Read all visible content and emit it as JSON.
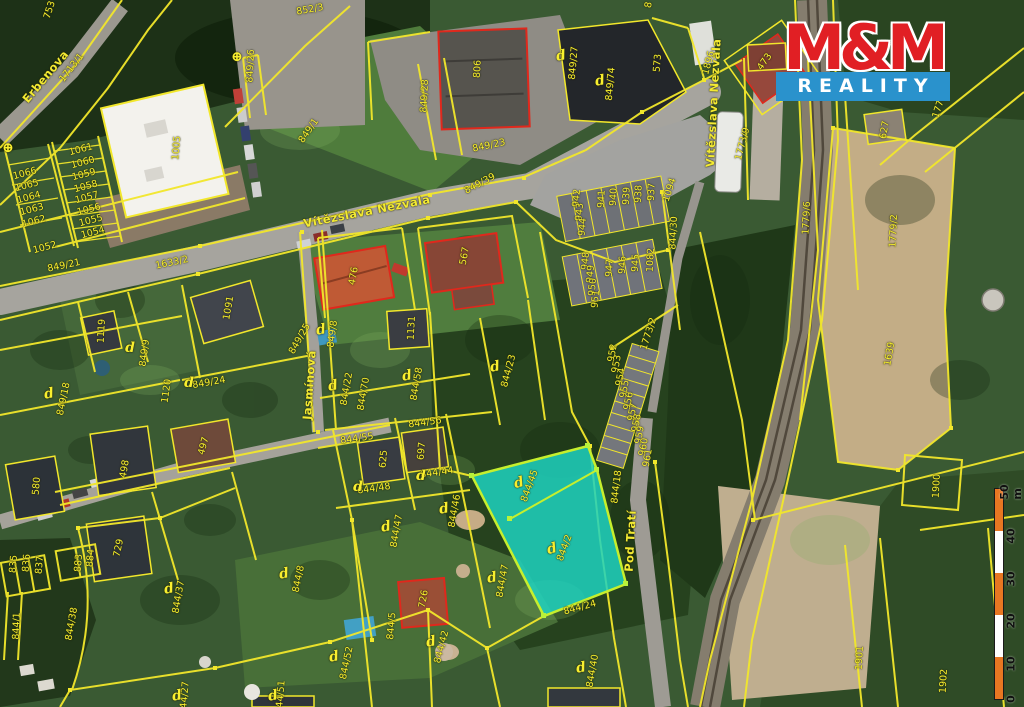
{
  "logo": {
    "top": "M&M",
    "bottom": "REALITY"
  },
  "colors": {
    "parcel_line": "#f2e72b",
    "parcel_label": "#f8ef2f",
    "building_outline_red": "#e0281c",
    "highlight_fill": "#1ed2c0",
    "highlight_stroke": "#c6ef2d",
    "logo_red": "#e11f24",
    "logo_blue": "#2a92cc",
    "scale_orange": "#e87722"
  },
  "map": {
    "highlighted_parcels": [
      "844/45",
      "844/2"
    ],
    "street_names": [
      "Erbenova",
      "Vítězslava Nezvala",
      "Jasmínová",
      "Pod Tratí"
    ],
    "labels": [
      {
        "t": "Erbenova",
        "x": 46,
        "y": 77,
        "r": -50,
        "k": "street"
      },
      {
        "t": "Vítězslava Nezvala",
        "x": 367,
        "y": 212,
        "r": -11,
        "k": "street"
      },
      {
        "t": "Vítězslava Nezvala",
        "x": 714,
        "y": 103,
        "r": -87,
        "k": "street"
      },
      {
        "t": "Jasmínová",
        "x": 310,
        "y": 385,
        "r": -86,
        "k": "street"
      },
      {
        "t": "Pod Tratí",
        "x": 631,
        "y": 541,
        "r": -87,
        "k": "street"
      },
      {
        "t": "852/3",
        "x": 310,
        "y": 10,
        "r": -10
      },
      {
        "t": "8",
        "x": 649,
        "y": 5,
        "r": -80
      },
      {
        "t": "753",
        "x": 50,
        "y": 10,
        "r": -72
      },
      {
        "t": "1713/1",
        "x": 72,
        "y": 68,
        "r": -52
      },
      {
        "t": "849/26",
        "x": 251,
        "y": 66,
        "r": -87
      },
      {
        "t": "849/1",
        "x": 309,
        "y": 131,
        "r": -55
      },
      {
        "t": "849/28",
        "x": 425,
        "y": 96,
        "r": -87
      },
      {
        "t": "806",
        "x": 478,
        "y": 69,
        "r": -87
      },
      {
        "t": "849/23",
        "x": 489,
        "y": 146,
        "r": -12
      },
      {
        "t": "849/39",
        "x": 480,
        "y": 184,
        "r": -28
      },
      {
        "t": "849/27",
        "x": 574,
        "y": 63,
        "r": -85
      },
      {
        "t": "849/74",
        "x": 611,
        "y": 84,
        "r": -85
      },
      {
        "t": "573",
        "x": 658,
        "y": 63,
        "r": -85
      },
      {
        "t": "1896",
        "x": 709,
        "y": 63,
        "r": -75
      },
      {
        "t": "473",
        "x": 765,
        "y": 62,
        "r": -55
      },
      {
        "t": "1773/9",
        "x": 743,
        "y": 144,
        "r": -75
      },
      {
        "t": "1779/8",
        "x": 941,
        "y": 102,
        "r": -72
      },
      {
        "t": "627",
        "x": 885,
        "y": 130,
        "r": -80
      },
      {
        "t": "1779/6",
        "x": 807,
        "y": 218,
        "r": -87
      },
      {
        "t": "1779/2",
        "x": 894,
        "y": 231,
        "r": -87
      },
      {
        "t": "1639",
        "x": 890,
        "y": 354,
        "r": -80
      },
      {
        "t": "1900",
        "x": 937,
        "y": 486,
        "r": -87
      },
      {
        "t": "1901",
        "x": 860,
        "y": 658,
        "r": -87
      },
      {
        "t": "1902",
        "x": 944,
        "y": 681,
        "r": -87
      },
      {
        "t": "1094",
        "x": 670,
        "y": 190,
        "r": -72
      },
      {
        "t": "942",
        "x": 577,
        "y": 198,
        "r": -85
      },
      {
        "t": "943",
        "x": 580,
        "y": 212,
        "r": -85
      },
      {
        "t": "944",
        "x": 583,
        "y": 227,
        "r": -85
      },
      {
        "t": "941",
        "x": 602,
        "y": 199,
        "r": -87
      },
      {
        "t": "940",
        "x": 614,
        "y": 197,
        "r": -87
      },
      {
        "t": "939",
        "x": 627,
        "y": 196,
        "r": -87
      },
      {
        "t": "938",
        "x": 639,
        "y": 194,
        "r": -87
      },
      {
        "t": "937",
        "x": 652,
        "y": 192,
        "r": -87
      },
      {
        "t": "948",
        "x": 586,
        "y": 261,
        "r": -85
      },
      {
        "t": "949",
        "x": 591,
        "y": 274,
        "r": -85
      },
      {
        "t": "950",
        "x": 593,
        "y": 287,
        "r": -85
      },
      {
        "t": "951",
        "x": 596,
        "y": 299,
        "r": -85
      },
      {
        "t": "947",
        "x": 610,
        "y": 268,
        "r": -87
      },
      {
        "t": "946",
        "x": 623,
        "y": 265,
        "r": -87
      },
      {
        "t": "945",
        "x": 636,
        "y": 263,
        "r": -87
      },
      {
        "t": "1082",
        "x": 651,
        "y": 260,
        "r": -87
      },
      {
        "t": "844/30",
        "x": 674,
        "y": 233,
        "r": -87
      },
      {
        "t": "952",
        "x": 613,
        "y": 353,
        "r": -80
      },
      {
        "t": "953",
        "x": 617,
        "y": 364,
        "r": -80
      },
      {
        "t": "954",
        "x": 621,
        "y": 377,
        "r": -80
      },
      {
        "t": "955",
        "x": 625,
        "y": 389,
        "r": -80
      },
      {
        "t": "956",
        "x": 629,
        "y": 401,
        "r": -80
      },
      {
        "t": "957",
        "x": 633,
        "y": 412,
        "r": -80
      },
      {
        "t": "958",
        "x": 637,
        "y": 423,
        "r": -80
      },
      {
        "t": "959",
        "x": 640,
        "y": 435,
        "r": -80
      },
      {
        "t": "960",
        "x": 644,
        "y": 447,
        "r": -80
      },
      {
        "t": "961",
        "x": 648,
        "y": 458,
        "r": -80
      },
      {
        "t": "1773/2",
        "x": 649,
        "y": 334,
        "r": -72
      },
      {
        "t": "844/18",
        "x": 617,
        "y": 487,
        "r": -83
      },
      {
        "t": "844/45",
        "x": 530,
        "y": 486,
        "r": -70
      },
      {
        "t": "844/2",
        "x": 565,
        "y": 548,
        "r": -70
      },
      {
        "t": "844/24",
        "x": 580,
        "y": 608,
        "r": -15
      },
      {
        "t": "844/46",
        "x": 455,
        "y": 511,
        "r": -80
      },
      {
        "t": "844/47",
        "x": 503,
        "y": 581,
        "r": -80
      },
      {
        "t": "844/47",
        "x": 397,
        "y": 531,
        "r": -80
      },
      {
        "t": "844/40",
        "x": 593,
        "y": 671,
        "r": -80
      },
      {
        "t": "844/42",
        "x": 442,
        "y": 647,
        "r": -75
      },
      {
        "t": "726",
        "x": 424,
        "y": 599,
        "r": -80
      },
      {
        "t": "844/5",
        "x": 392,
        "y": 626,
        "r": -85
      },
      {
        "t": "844/52",
        "x": 347,
        "y": 663,
        "r": -78
      },
      {
        "t": "844/51",
        "x": 281,
        "y": 697,
        "r": -85
      },
      {
        "t": "844/27",
        "x": 185,
        "y": 698,
        "r": -85
      },
      {
        "t": "844/8",
        "x": 299,
        "y": 579,
        "r": -78
      },
      {
        "t": "844/37",
        "x": 179,
        "y": 597,
        "r": -80
      },
      {
        "t": "844/38",
        "x": 72,
        "y": 624,
        "r": -80
      },
      {
        "t": "844/1",
        "x": 17,
        "y": 626,
        "r": -88
      },
      {
        "t": "883",
        "x": 79,
        "y": 563,
        "r": -85
      },
      {
        "t": "884",
        "x": 91,
        "y": 558,
        "r": -85
      },
      {
        "t": "835",
        "x": 14,
        "y": 564,
        "r": -85
      },
      {
        "t": "836",
        "x": 27,
        "y": 563,
        "r": -85
      },
      {
        "t": "837",
        "x": 40,
        "y": 565,
        "r": -85
      },
      {
        "t": "729",
        "x": 119,
        "y": 548,
        "r": -78
      },
      {
        "t": "580",
        "x": 37,
        "y": 486,
        "r": -85
      },
      {
        "t": "498",
        "x": 125,
        "y": 469,
        "r": -80
      },
      {
        "t": "497",
        "x": 204,
        "y": 446,
        "r": -75
      },
      {
        "t": "625",
        "x": 384,
        "y": 459,
        "r": -85
      },
      {
        "t": "697",
        "x": 422,
        "y": 451,
        "r": -85
      },
      {
        "t": "844/56",
        "x": 425,
        "y": 423,
        "r": -8
      },
      {
        "t": "844/55",
        "x": 357,
        "y": 439,
        "r": -8
      },
      {
        "t": "844/44",
        "x": 437,
        "y": 473,
        "r": -8
      },
      {
        "t": "844/48",
        "x": 374,
        "y": 489,
        "r": -8
      },
      {
        "t": "844/23",
        "x": 509,
        "y": 371,
        "r": -75
      },
      {
        "t": "844/58",
        "x": 417,
        "y": 384,
        "r": -80
      },
      {
        "t": "844/22",
        "x": 347,
        "y": 389,
        "r": -80
      },
      {
        "t": "844/70",
        "x": 364,
        "y": 394,
        "r": -80
      },
      {
        "t": "849/25",
        "x": 300,
        "y": 339,
        "r": -60
      },
      {
        "t": "849/8",
        "x": 333,
        "y": 334,
        "r": -82
      },
      {
        "t": "1131",
        "x": 412,
        "y": 328,
        "r": -87
      },
      {
        "t": "476",
        "x": 354,
        "y": 276,
        "r": -80
      },
      {
        "t": "567",
        "x": 465,
        "y": 256,
        "r": -80
      },
      {
        "t": "1119",
        "x": 102,
        "y": 331,
        "r": -87
      },
      {
        "t": "1091",
        "x": 229,
        "y": 308,
        "r": -80
      },
      {
        "t": "849/18",
        "x": 64,
        "y": 399,
        "r": -78
      },
      {
        "t": "1120",
        "x": 167,
        "y": 391,
        "r": -82
      },
      {
        "t": "849/24",
        "x": 209,
        "y": 383,
        "r": -10
      },
      {
        "t": "849/9",
        "x": 145,
        "y": 353,
        "r": -82
      },
      {
        "t": "849/21",
        "x": 64,
        "y": 266,
        "r": -12
      },
      {
        "t": "1633/2",
        "x": 172,
        "y": 263,
        "r": -12
      },
      {
        "t": "1005",
        "x": 177,
        "y": 148,
        "r": -85
      },
      {
        "t": "1061",
        "x": 81,
        "y": 150,
        "r": -15
      },
      {
        "t": "1060",
        "x": 83,
        "y": 163,
        "r": -15
      },
      {
        "t": "1059",
        "x": 84,
        "y": 175,
        "r": -15
      },
      {
        "t": "1058",
        "x": 86,
        "y": 187,
        "r": -15
      },
      {
        "t": "1057",
        "x": 87,
        "y": 198,
        "r": -15
      },
      {
        "t": "1056",
        "x": 89,
        "y": 210,
        "r": -15
      },
      {
        "t": "1055",
        "x": 91,
        "y": 221,
        "r": -15
      },
      {
        "t": "1054",
        "x": 93,
        "y": 233,
        "r": -15
      },
      {
        "t": "1066",
        "x": 25,
        "y": 174,
        "r": -15
      },
      {
        "t": "1065",
        "x": 27,
        "y": 186,
        "r": -15
      },
      {
        "t": "1064",
        "x": 29,
        "y": 198,
        "r": -15
      },
      {
        "t": "1063",
        "x": 32,
        "y": 210,
        "r": -15
      },
      {
        "t": "1062",
        "x": 34,
        "y": 222,
        "r": -15
      },
      {
        "t": "1052",
        "x": 45,
        "y": 248,
        "r": -15
      }
    ],
    "marks": [
      {
        "g": "d",
        "x": 561,
        "y": 56,
        "r": -10
      },
      {
        "g": "d",
        "x": 600,
        "y": 81,
        "r": -10
      },
      {
        "g": "d",
        "x": 321,
        "y": 330,
        "r": -10
      },
      {
        "g": "d",
        "x": 333,
        "y": 386,
        "r": -10
      },
      {
        "g": "d",
        "x": 407,
        "y": 376,
        "r": -10
      },
      {
        "g": "d",
        "x": 495,
        "y": 367,
        "r": -10
      },
      {
        "g": "d",
        "x": 49,
        "y": 394,
        "r": -10
      },
      {
        "g": "d",
        "x": 189,
        "y": 383,
        "r": 0
      },
      {
        "g": "d",
        "x": 130,
        "y": 348,
        "r": 0
      },
      {
        "g": "d",
        "x": 519,
        "y": 483,
        "r": -15
      },
      {
        "g": "d",
        "x": 552,
        "y": 549,
        "r": -15
      },
      {
        "g": "d",
        "x": 444,
        "y": 509,
        "r": -10
      },
      {
        "g": "d",
        "x": 492,
        "y": 578,
        "r": -10
      },
      {
        "g": "d",
        "x": 386,
        "y": 527,
        "r": -10
      },
      {
        "g": "d",
        "x": 284,
        "y": 574,
        "r": -10
      },
      {
        "g": "d",
        "x": 169,
        "y": 589,
        "r": -10
      },
      {
        "g": "d",
        "x": 581,
        "y": 668,
        "r": -10
      },
      {
        "g": "d",
        "x": 431,
        "y": 642,
        "r": -10
      },
      {
        "g": "d",
        "x": 334,
        "y": 657,
        "r": -10
      },
      {
        "g": "d",
        "x": 273,
        "y": 696,
        "r": -10
      },
      {
        "g": "d",
        "x": 177,
        "y": 696,
        "r": -10
      },
      {
        "g": "d",
        "x": 358,
        "y": 487,
        "r": 0
      },
      {
        "g": "d",
        "x": 421,
        "y": 476,
        "r": 0
      },
      {
        "g": "⊕",
        "x": 237,
        "y": 57,
        "r": 0
      },
      {
        "g": "⊕",
        "x": 8,
        "y": 148,
        "r": 0
      }
    ]
  },
  "scale_bar": {
    "segments": [
      "#e87722",
      "#ffffff",
      "#e87722",
      "#ffffff",
      "#e87722"
    ],
    "label_x": 1011,
    "labels": [
      {
        "t": "50 m",
        "y": 492
      },
      {
        "t": "40",
        "y": 536
      },
      {
        "t": "30",
        "y": 579
      },
      {
        "t": "20",
        "y": 621
      },
      {
        "t": "10",
        "y": 664
      },
      {
        "t": "0",
        "y": 699
      }
    ]
  }
}
